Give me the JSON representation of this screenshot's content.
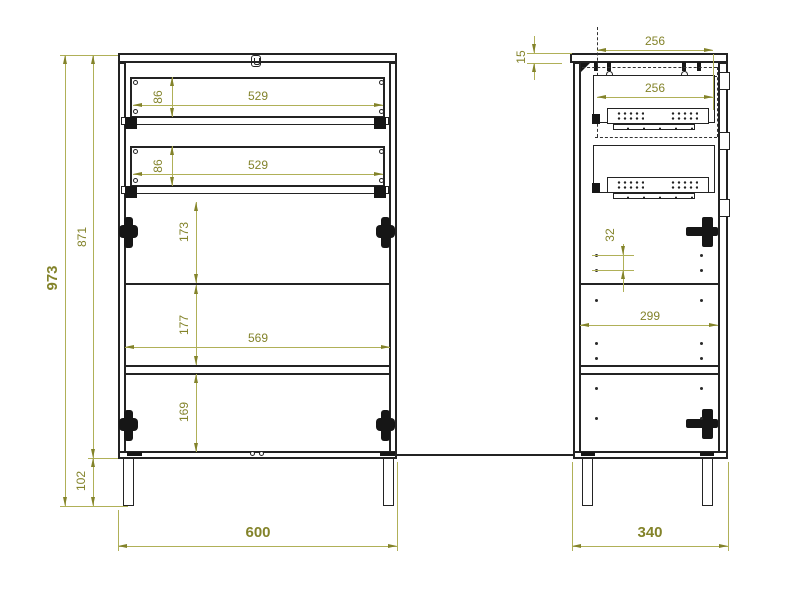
{
  "drawing": {
    "type": "furniture-technical-drawing",
    "colors": {
      "background": "#ffffff",
      "line": "#232323",
      "dimension": "#83832a"
    },
    "icons": {
      "keyhole": "keyhole-icon",
      "hinge_front": "hinge-icon",
      "hinge_side": "hinge-icon",
      "drawer_slide": "perforated-rail-icon"
    },
    "dims": {
      "front": {
        "total_height": "973",
        "carcass_height": "871",
        "leg_height": "102",
        "total_width": "600",
        "interior_width": "569",
        "drawer1_height": "86",
        "drawer1_width": "529",
        "drawer2_height": "86",
        "drawer2_width": "529",
        "drawer_to_shelf": "173",
        "shelf_spacing": "177",
        "bottom_spacing": "169"
      },
      "side": {
        "top_offset": "15",
        "slide_length_top": "256",
        "slide_length_bottom": "256",
        "hole_pitch": "32",
        "interior_depth": "299",
        "total_depth": "340"
      }
    }
  }
}
